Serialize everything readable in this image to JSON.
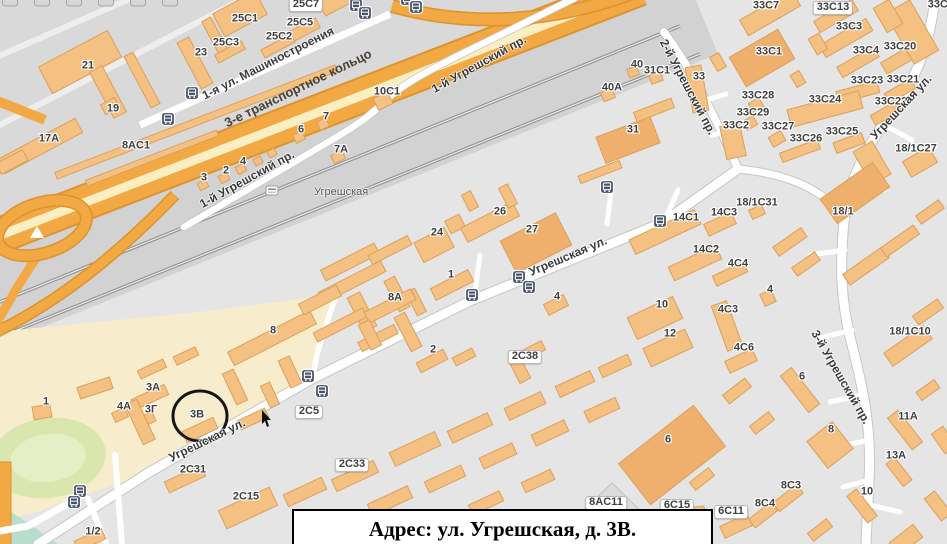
{
  "caption": {
    "text": "Адрес: ул. Угрешская, д. 3В."
  },
  "map": {
    "station": {
      "name": "Угрешская",
      "x": 314,
      "y": 192
    },
    "street_labels": [
      {
        "t": "1-я ул. Машиностроения",
        "x": 268,
        "y": 63,
        "r": -27
      },
      {
        "t": "3-е транспортное кольцо",
        "x": 298,
        "y": 88,
        "r": -26,
        "c": "hwy"
      },
      {
        "t": "1-й Угрешский пр.",
        "x": 247,
        "y": 179,
        "r": -29
      },
      {
        "t": "1-й Угрешский пр.",
        "x": 479,
        "y": 64,
        "r": -29
      },
      {
        "t": "Угрешская ул.",
        "x": 568,
        "y": 256,
        "r": -23
      },
      {
        "t": "Угрешская ул.",
        "x": 207,
        "y": 440,
        "r": -26
      },
      {
        "t": "Угрешская ул.",
        "x": 901,
        "y": 107,
        "r": -47
      },
      {
        "t": "2-й Угрешский пр.",
        "x": 688,
        "y": 87,
        "r": 62
      },
      {
        "t": "3-й Угрешский пр.",
        "x": 841,
        "y": 377,
        "r": 60
      }
    ],
    "building_labels": [
      {
        "t": "21",
        "x": 88,
        "y": 66
      },
      {
        "t": "19",
        "x": 113,
        "y": 109
      },
      {
        "t": "17A",
        "x": 49,
        "y": 139
      },
      {
        "t": "8AC1",
        "x": 136,
        "y": 146
      },
      {
        "t": "23",
        "x": 201,
        "y": 53
      },
      {
        "t": "25C3",
        "x": 226,
        "y": 43
      },
      {
        "t": "25C1",
        "x": 245,
        "y": 19
      },
      {
        "t": "25C2",
        "x": 279,
        "y": 37
      },
      {
        "t": "25C5",
        "x": 300,
        "y": 23
      },
      {
        "t": "25C7",
        "x": 306,
        "y": 5,
        "p": 1
      },
      {
        "t": "10C1",
        "x": 387,
        "y": 92
      },
      {
        "t": "7",
        "x": 326,
        "y": 117
      },
      {
        "t": "6",
        "x": 301,
        "y": 130
      },
      {
        "t": "7A",
        "x": 341,
        "y": 150
      },
      {
        "t": "3",
        "x": 204,
        "y": 178
      },
      {
        "t": "2",
        "x": 226,
        "y": 171
      },
      {
        "t": "4",
        "x": 243,
        "y": 162
      },
      {
        "t": "26",
        "x": 500,
        "y": 212
      },
      {
        "t": "27",
        "x": 532,
        "y": 230
      },
      {
        "t": "24",
        "x": 437,
        "y": 233
      },
      {
        "t": "1",
        "x": 451,
        "y": 275
      },
      {
        "t": "8A",
        "x": 395,
        "y": 298
      },
      {
        "t": "4",
        "x": 557,
        "y": 297
      },
      {
        "t": "2",
        "x": 433,
        "y": 350
      },
      {
        "t": "2C38",
        "x": 525,
        "y": 357,
        "p": 1
      },
      {
        "t": "8",
        "x": 273,
        "y": 331
      },
      {
        "t": "40",
        "x": 637,
        "y": 65
      },
      {
        "t": "40A",
        "x": 612,
        "y": 88
      },
      {
        "t": "31C1",
        "x": 657,
        "y": 71
      },
      {
        "t": "33",
        "x": 699,
        "y": 77
      },
      {
        "t": "31",
        "x": 633,
        "y": 130
      },
      {
        "t": "33C7",
        "x": 766,
        "y": 6
      },
      {
        "t": "33C13",
        "x": 833,
        "y": 8,
        "p": 1
      },
      {
        "t": "33C3",
        "x": 849,
        "y": 27
      },
      {
        "t": "33C1",
        "x": 769,
        "y": 52
      },
      {
        "t": "33C4",
        "x": 866,
        "y": 51
      },
      {
        "t": "33C20",
        "x": 900,
        "y": 47
      },
      {
        "t": "33C23",
        "x": 867,
        "y": 81
      },
      {
        "t": "33C21",
        "x": 903,
        "y": 80
      },
      {
        "t": "33C24",
        "x": 825,
        "y": 100
      },
      {
        "t": "33C22",
        "x": 891,
        "y": 102
      },
      {
        "t": "33C28",
        "x": 758,
        "y": 96
      },
      {
        "t": "33C29",
        "x": 753,
        "y": 113
      },
      {
        "t": "33C2",
        "x": 736,
        "y": 126
      },
      {
        "t": "33C27",
        "x": 778,
        "y": 127
      },
      {
        "t": "33C26",
        "x": 806,
        "y": 139
      },
      {
        "t": "33C25",
        "x": 842,
        "y": 132
      },
      {
        "t": "18/1C27",
        "x": 916,
        "y": 149
      },
      {
        "t": "33C14",
        "x": 944,
        "y": 5
      },
      {
        "t": "18/1C31",
        "x": 757,
        "y": 203
      },
      {
        "t": "14C1",
        "x": 686,
        "y": 218
      },
      {
        "t": "14C3",
        "x": 724,
        "y": 213
      },
      {
        "t": "14C2",
        "x": 706,
        "y": 250
      },
      {
        "t": "4C4",
        "x": 738,
        "y": 264
      },
      {
        "t": "4",
        "x": 770,
        "y": 290
      },
      {
        "t": "4C3",
        "x": 728,
        "y": 310
      },
      {
        "t": "4C6",
        "x": 744,
        "y": 348
      },
      {
        "t": "10",
        "x": 662,
        "y": 305
      },
      {
        "t": "12",
        "x": 670,
        "y": 334
      },
      {
        "t": "18/1",
        "x": 843,
        "y": 212
      },
      {
        "t": "18/1C10",
        "x": 910,
        "y": 332
      },
      {
        "t": "1",
        "x": 46,
        "y": 402
      },
      {
        "t": "3A",
        "x": 153,
        "y": 388
      },
      {
        "t": "4A",
        "x": 124,
        "y": 407
      },
      {
        "t": "3Г",
        "x": 151,
        "y": 410
      },
      {
        "t": "3В",
        "x": 197,
        "y": 415
      },
      {
        "t": "2C5",
        "x": 309,
        "y": 412,
        "p": 1
      },
      {
        "t": "2C31",
        "x": 193,
        "y": 470
      },
      {
        "t": "2C15",
        "x": 246,
        "y": 497
      },
      {
        "t": "1/2",
        "x": 93,
        "y": 532
      },
      {
        "t": "2C33",
        "x": 352,
        "y": 465,
        "p": 1
      },
      {
        "t": "8AC11",
        "x": 606,
        "y": 503,
        "p": 1
      },
      {
        "t": "6C15",
        "x": 677,
        "y": 506,
        "p": 1
      },
      {
        "t": "6C11",
        "x": 731,
        "y": 512,
        "p": 1
      },
      {
        "t": "6",
        "x": 668,
        "y": 440
      },
      {
        "t": "6",
        "x": 802,
        "y": 377
      },
      {
        "t": "8",
        "x": 831,
        "y": 430
      },
      {
        "t": "8C3",
        "x": 791,
        "y": 486
      },
      {
        "t": "8C4",
        "x": 765,
        "y": 504
      },
      {
        "t": "11A",
        "x": 908,
        "y": 417
      },
      {
        "t": "13A",
        "x": 896,
        "y": 456
      },
      {
        "t": "10",
        "x": 867,
        "y": 492
      }
    ],
    "icon_names": [
      "bus-stop-icon",
      "railway-station-icon",
      "annotation-circle"
    ],
    "colors": {
      "background": "#e5e5e5",
      "city_blocks": "#d9d9d9",
      "railway_band": "#d2d2d2",
      "industrial_zone": "#f7eccb",
      "stadium_green": "#d9e6ae",
      "park_teal": "#b8ddcf",
      "building_fill": "#f4c183",
      "building_dark": "#eeb06c",
      "building_stroke": "#dba05a",
      "highway_orange": "#f2a843",
      "highway_core": "#faeec3",
      "highway_casing": "#db9430",
      "road_white": "#ffffff",
      "road_casing": "#c6c6c6",
      "bus_icon": "#47536b",
      "annotation": "#151515"
    }
  }
}
